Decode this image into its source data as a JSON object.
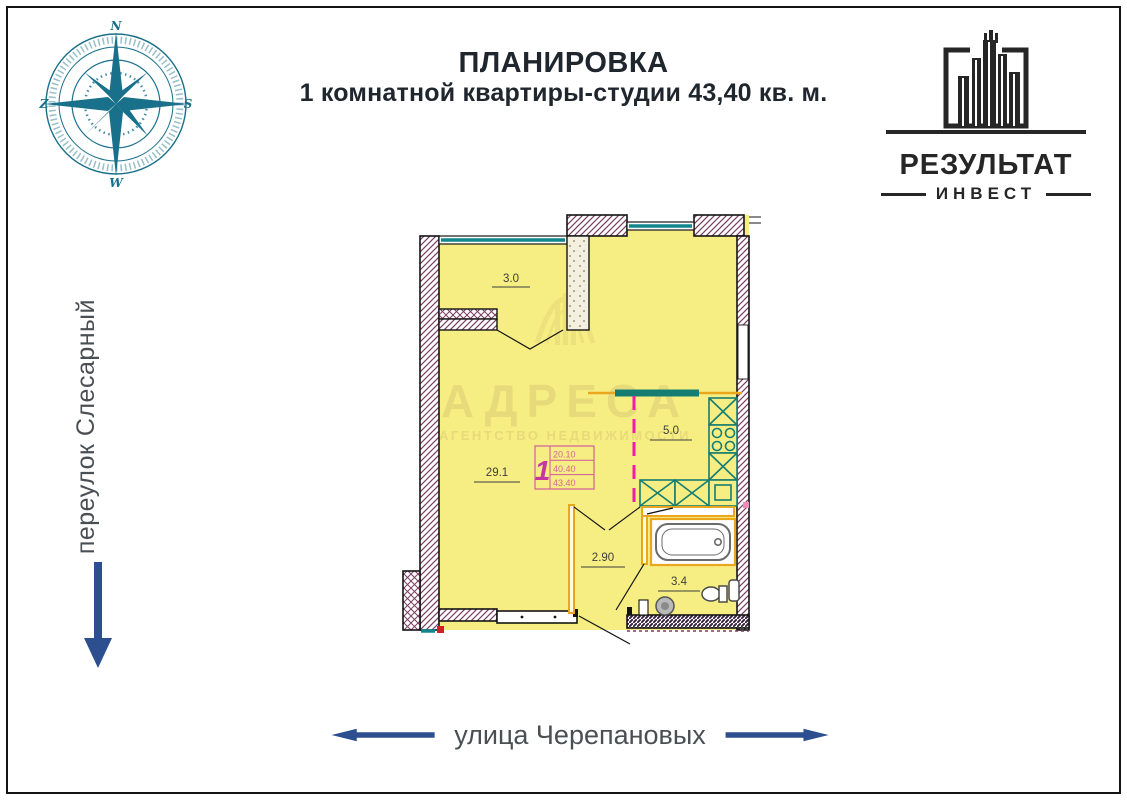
{
  "header": {
    "line1": "ПЛАНИРОВКА",
    "line2": "1 комнатной квартиры-студии 43,40 кв. м."
  },
  "logo": {
    "name": "РЕЗУЛЬТАТ",
    "sub": "ИНВЕСТ"
  },
  "compass": {
    "top": "N",
    "right": "S",
    "bottom": "W",
    "left": "Z"
  },
  "streets": {
    "left": "переулок Слесарный",
    "bottom": "улица Черепановых"
  },
  "plan": {
    "areas": {
      "loggia": "3.0",
      "living": "29.1",
      "kitchen": "5.0",
      "hall": "2.90",
      "bath": "3.4"
    },
    "stamp": {
      "rooms": "1",
      "row1": "20.10",
      "row2": "40.40",
      "row3": "43.40"
    }
  },
  "watermark": {
    "line1": "АДРЕСА",
    "line2": "АГЕНТСТВО НЕДВИЖИМОСТИ"
  },
  "colors": {
    "room_fill": "#f6ee82",
    "wall_hatch": "#7b3e63",
    "window_teal": "#12868c",
    "kitchen_teal": "#157d72",
    "partition_orange": "#eaa71e",
    "dashed_magenta": "#ef1ea6",
    "stamp_pink": "#d4679a",
    "arrow_blue": "#2d4e8f",
    "compass_teal": "#19708a"
  }
}
